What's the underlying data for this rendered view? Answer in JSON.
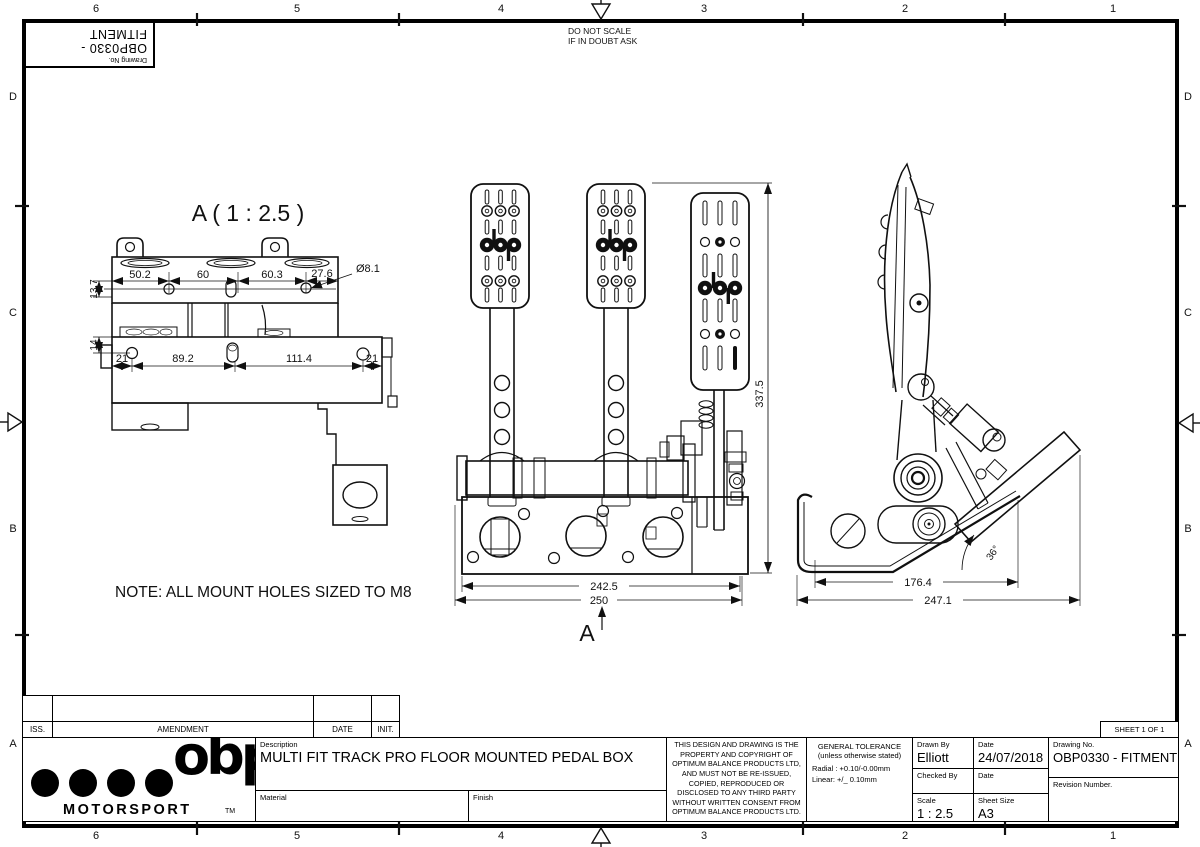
{
  "frame": {
    "scale_note": [
      "DO NOT SCALE",
      "IF IN DOUBT ASK"
    ],
    "cols": [
      "6",
      "5",
      "4",
      "3",
      "2",
      "1"
    ],
    "rows": [
      "D",
      "C",
      "B",
      "A"
    ],
    "corner_box": {
      "label": "Drawing No.",
      "value": "OBP0330 - FITMENT"
    }
  },
  "drawing": {
    "detail_view": {
      "title": "A ( 1 : 2.5 )",
      "dims_top": [
        "50.2",
        "60",
        "60.3",
        "27.6"
      ],
      "dim_hole": "Ø8.1",
      "dims_left": [
        "13.7",
        "14"
      ],
      "dims_bottom": [
        "21",
        "89.2",
        "111.4",
        "21"
      ]
    },
    "front_view": {
      "dim_height": "337.5",
      "dim_width_inner": "242.5",
      "dim_width_outer": "250",
      "section_label": "A"
    },
    "side_view": {
      "dim_width_inner": "176.4",
      "dim_width_outer": "247.1",
      "dim_angle": "36°"
    },
    "note": "NOTE: ALL MOUNT HOLES SIZED TO M8"
  },
  "title_block": {
    "amendment": {
      "iss": "ISS.",
      "amendment": "AMENDMENT",
      "date": "DATE",
      "init": "INIT."
    },
    "logo": {
      "word": "obp",
      "sub": "MOTORSPORT",
      "tm": "TM"
    },
    "description": {
      "label": "Description",
      "value": "MULTI FIT TRACK PRO FLOOR MOUNTED PEDAL BOX"
    },
    "material": {
      "label": "Material",
      "value": ""
    },
    "finish": {
      "label": "Finish",
      "value": ""
    },
    "copyright": "THIS DESIGN AND DRAWING IS THE PROPERTY AND COPYRIGHT OF OPTIMUM BALANCE PRODUCTS LTD, AND MUST NOT BE RE-ISSUED, COPIED, REPRODUCED OR DISCLOSED TO ANY THIRD PARTY WITHOUT WRITTEN CONSENT FROM OPTIMUM BALANCE PRODUCTS LTD.",
    "tolerance": {
      "title": "GENERAL TOLERANCE",
      "subtitle": "(unless otherwise stated)",
      "radial": "Radial : +0.10/-0.00mm",
      "linear": "Linear: +/_ 0.10mm"
    },
    "drawn_by": {
      "label": "Drawn By",
      "value": "Elliott"
    },
    "drawn_date": {
      "label": "Date",
      "value": "24/07/2018"
    },
    "checked_by": {
      "label": "Checked By",
      "value": ""
    },
    "checked_date": {
      "label": "Date",
      "value": ""
    },
    "scale": {
      "label": "Scale",
      "value": "1 : 2.5"
    },
    "sheet_size": {
      "label": "Sheet Size",
      "value": "A3"
    },
    "drawing_no": {
      "label": "Drawing No.",
      "value": "OBP0330 - FITMENT"
    },
    "revision": {
      "label": "Revision Number.",
      "value": ""
    },
    "sheet_info": "SHEET 1  OF 1"
  }
}
